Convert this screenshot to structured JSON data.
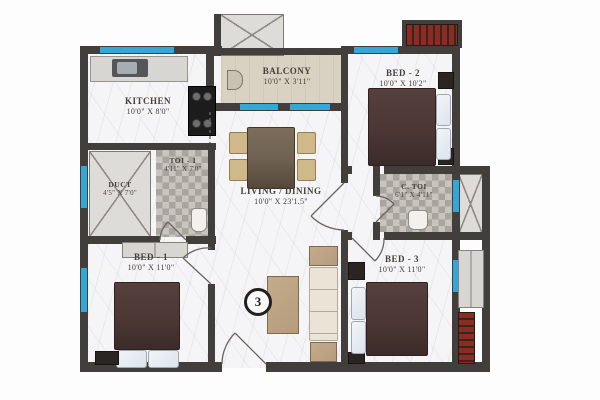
{
  "colors": {
    "wall": "#413e3c",
    "window": "#33a7d8",
    "floor": "#f5f5f7",
    "balcony-floor": "#d9d2c3",
    "tile-light": "#c9c5be",
    "tile-dark": "#a9a49c",
    "bed-blanket": "#4a3633",
    "pillow": "#dde4ec",
    "wood": "#b59c7d",
    "table": "#6e6050",
    "chair": "#cfb98b",
    "sofa": "#eae4d6",
    "red-unit": "#8e2b20"
  },
  "rooms": {
    "kitchen": {
      "name": "KITCHEN",
      "dim": "10'0\" X 8'0\""
    },
    "balcony": {
      "name": "BALCONY",
      "dim": "10'0\" X 3'11\""
    },
    "bed2": {
      "name": "BED - 2",
      "dim": "10'0\" X 10'2\""
    },
    "toi1": {
      "name": "TOI - 1",
      "dim": "4'11\" X 7'0\""
    },
    "duct": {
      "name": "DUCT",
      "dim": "4'5\" X 7'0\""
    },
    "living": {
      "name": "LIVING / DINING",
      "dim": "10'0\" X 23'1.5\""
    },
    "ctoi": {
      "name": "C. TOI",
      "dim": "6'1\" X 4'11\""
    },
    "bed1": {
      "name": "BED - 1",
      "dim": "10'0\" X 11'0\""
    },
    "bed3": {
      "name": "BED - 3",
      "dim": "10'0\" X 11'0\""
    }
  },
  "marker": {
    "label": "3"
  }
}
